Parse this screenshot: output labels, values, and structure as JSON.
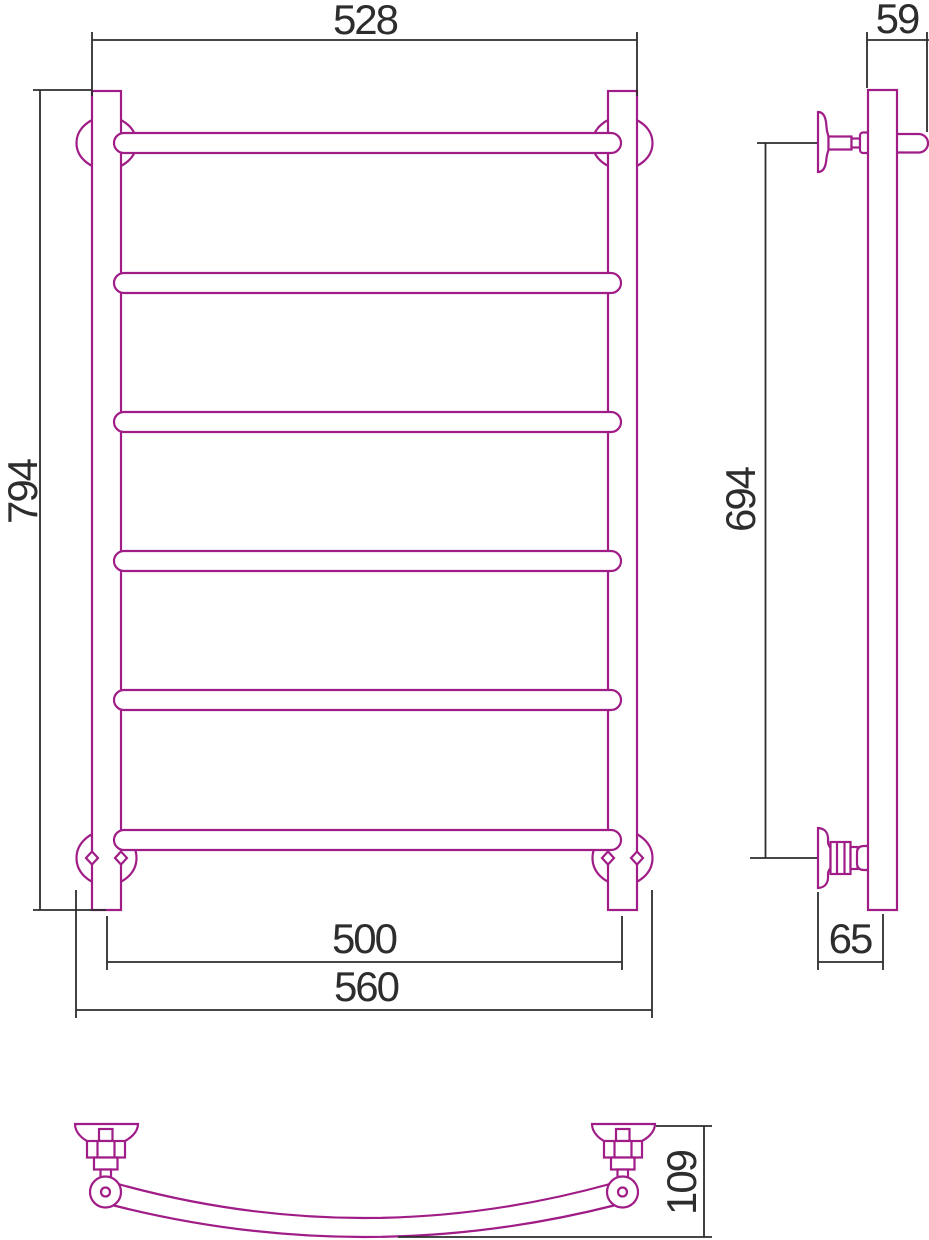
{
  "drawing": {
    "kind": "technical-drawing",
    "subject": "ladder towel rail with wall brackets, three orthographic views"
  },
  "colors": {
    "product_outline": "#A01C87",
    "dimension_lines": "#2D2D2D",
    "background": "#FFFFFF"
  },
  "dims": {
    "front": {
      "outer_width": "528",
      "height": "794",
      "centers_width": "500",
      "brackets_width": "560"
    },
    "side": {
      "top_depth": "59",
      "brackets_span": "694",
      "wall_to_axis": "65"
    },
    "bottom": {
      "bar_depth": "109"
    }
  }
}
